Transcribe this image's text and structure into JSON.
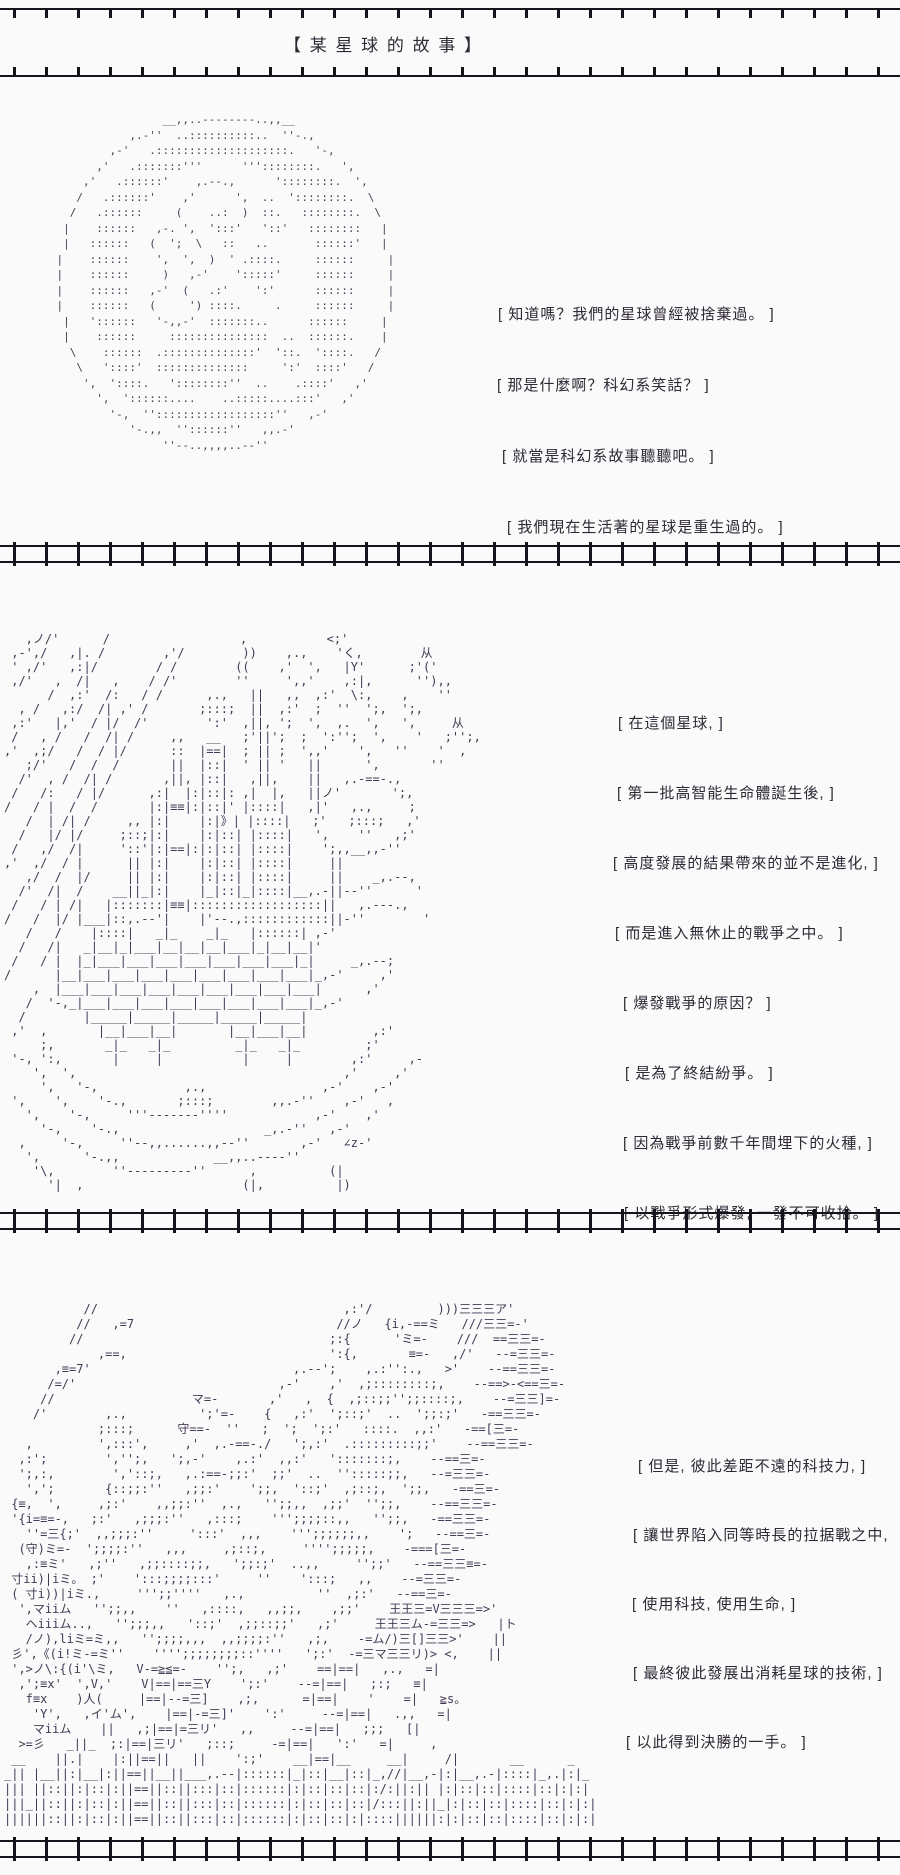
{
  "page": {
    "title": "【 某 星 球 的 故 事 】",
    "background_color": "#fafafa",
    "line_color": "#14141d",
    "text_color": "#2e2935",
    "art_color": "#453a55"
  },
  "panels": [
    {
      "label": "panel-1-abandoned-planet",
      "dialogue": [
        "[ 知道嗎？我們的星球曾經被捨棄過。 ]",
        "[ 那是什麼啊？科幻系笑話？ ]",
        "[ 就當是科幻系故事聽聽吧。 ]",
        "[ 我們現在生活著的星球是重生過的。 ]"
      ],
      "art": [
        "                    __,,..--------..,,__",
        "               ,.-''  ..::::::::::..  ''-.,",
        "            ,-'   .::::::::::::::::::::.   '-,",
        "          ,'   .:::::::'''      '''::::::::.   ',",
        "        ,'   .::::::'    ,.--.,      '::::::::.  ',",
        "       /   .::::::'    ,'      ',  ..  '::::::::.  \\",
        "      /   .::::::     (    ..:  )  ::.   ::::::::.  \\",
        "     |    ::::::   ,-. ',  ':::'   '::'   ::::::::   |",
        "     |   ::::::   (  ';  \\   ::   ..       ::::::'   |",
        "    |    ::::::    ',  ',  )  ' .::::.     ::::::     |",
        "    |    ::::::     )   ,-'    ':::::'     ::::::     |",
        "    |    ::::::   ,-'  (   .:'    ':'      ::::::     |",
        "    |    ::::::   (     ') ::::.     .     ::::::     |",
        "     |   '::::::   '-,,-'  :::::::..      ::::::     |",
        "     |    ::::::     :::::::::::::::  ..  ::::::.    |",
        "      \\    ::::::  .::::::::::::::'  '::.  '::::.   /",
        "       \\   '::::'  ::::::::::::::     ':'  ::::'   /",
        "        ',  '::::.   '::::::::''  ..    .::::'   ,'",
        "          ',  '::::::....    ..:::::....:::'   ,'",
        "            '-,  ''::::::::::::::::::''   ,-'",
        "               '-.,,  ''::::::''   ,,.-'",
        "                    ''--..,,,,..--''"
      ]
    },
    {
      "label": "panel-2-war-city",
      "dialogue": [
        "[ 在這個星球, ]",
        "[ 第一批高智能生命體誕生後, ]",
        "[ 高度發展的結果帶來的並不是進化, ]",
        "[ 而是進入無休止的戰爭之中。 ]",
        "[ 爆發戰爭的原因？ ]",
        "[ 是為了終結紛爭。 ]",
        "[ 因為戰爭前數千年間埋下的火種, ]",
        "[ 以戰爭形式爆發, 一發不可收拾。 ]"
      ],
      "art": [
        "   ,ノ/'      /                  ,           <;'",
        " ,-',/   ,|. /        ,'/        ))    ,.,    'く,        从",
        " ' ,/'   ,:|/        / /        ((    ,'  ',   |Y'      ;'('",
        " ,/'   ,  /|   ,    / /'        ''     ',,'    ,:|,      ''),,",
        "      /  ,:'  /:   / /      ,.,   ||   ,,  ,:'  \\:,    ,    ''",
        "  , /   ,:/  /| ,' /       ;:::;  ||  ,:'  ;  ''  ';,  ';,",
        " ,:'   |,'  / |/  /'        ':'  ,||, ';  ',  ,.  ',   ',     从",
        " /   , /   /  /| /     ,,   __   ;'||';  ;  ':'';  ',    '   ;'';,",
        ",'  ,;/   /  / |/      ::  |==|  ; || ;  ',,'    ',   ''    '  ,",
        "   ;/'   /  /  /       ||  |::|  ' || '   ||      ',       ''",
        "  /'  , /  /| /       ,||, |::|   ,||,    ||   ,.-==-.,",
        " /   /:   / |/      ,:|  |:|::|: ,|  |,   ||ノ'       ';,",
        "/   / |  /  /       |:|≡≡|:|::|' |::::|   ,|'   ,.,     ;",
        "   /  | /| /     ,, |:|    |:|》| |::::|   ;'   ;:::;   ,'",
        "  /   |/ |/     ;::;|:|    |:|::| |::::|   ',    ''   ,;'",
        " /   ,/  /|     '::'|:|==|:|:|::| |::::|    ';,,__,,-''",
        ",'  ,/  / |      || |:|    |:|::| |::::|     ||",
        "   ,/  /  |/     || |:|    |:|::| |::::|     ||    _,.--,",
        "  /'  /|  /    __||_|:|    |_|::|_|::::|__,.-||--''      '",
        " /   / | /|   |:::::::|≡≡|::::::::::::::::::||   ,.---.,",
        "/   /  |/ |___|::,.--'|    |'--.,::::::::::::||-''        '",
        "   /   /    |::::|   _|_    _|_   |::::::| ,-'",
        "  /   /|   _|__|_|___|__|__|__|___|_|__|__|'",
        " /   / |  |_|___|___|___|___|___|___|___|_|     _,.--;",
        "/      |__|___|___|___|___|___|___|___|___|_,-'     ,'",
        "    ,  |___|___|___|___|___|___|___|___|___|      ,'",
        "   /  '-,_|___|___|___|___|___|___|___|___|_,-'",
        "  /        |_____|_____|_____|_____|_____|",
        " ,'  ,       |__|___|__|       |__|___|__|         ,:'",
        "     ;,       _|_   _|_         _|_   _|_         ;'",
        " '-, ':,       |     |           |     |        ,:'     ,-",
        "    ',  ',                                     ,'     ,'",
        "     ',   '-,            ,.,                ,-'    ,-'",
        " ',    ',    '-.,       ;:::;        ,,.-''    ,-'   ,",
        "   ',    '-,     '''-------''''            ,-'    ,'",
        "     '-,    '-.,                    _,.-''   ,-'",
        "  ,     '-,     ''--,,......,,--''       ,-'   ∠z-'",
        "   ',      '-.,,             __,,..----''",
        "    '\\,        ''---------''      ,          (|",
        "      '|  ,                      (|,          |)"
      ]
    },
    {
      "label": "panel-3-final-weapon",
      "dialogue": [
        "[ 但是, 彼此差距不遠的科技力, ]",
        "[ 讓世界陷入同等時長的拉据戰之中,",
        "[ 使用科技, 使用生命, ]",
        "[ 最終彼此發展出消耗星球的技術, ]",
        "[ 以此得到決勝的一手。 ]"
      ],
      "art": [
        "           //                                  ,:'/         )))三三三ア'",
        "          //   ,=7                            //ノ   {i,-==ミ   ///三三=-'",
        "         //                                  ;:{      'ミ=-    ///  ==三三=-",
        "             ,==,                            ':{,       ≡=-   ,/'   --=三三=-",
        "       ,≡=7'                            ,.--';    ,.:'':.,   >'    --==三三=-",
        "      /=/'                            ,-'    ,'  ,;::::::::;,    --==>-<==三=-",
        "     //                   マ=-       ,'   ,  {  ,;::;;'';;::::;,    --=三三]=-",
        "    /'        ,.,          ';'=-    {   ,:'  ';::;'  ..  ';;:;'   -==三三=-",
        "             ;:::;      守==-  ''   ;  ';  ';:'   ::::.  ,,:'   -==[三=-",
        "   ,         ',:::',     ,'  ,.-==-./   ';,:'  .:::::::::;;'    --==三三=-",
        "  ,:';        ','';,   ';,-'    ,.:'  ,,:'   ':::::::;,    --==三=-",
        "  ';,:,        ','::;,   ,.:==-;;:'  ;;'  ..  '':::::;;,   --=三三=-",
        "   ',';       {::;;:''   ,;;:'    ';;,  '::;'  ,;::;,  ';;,   -==三=-",
        " {≡,  ',     ,;:'    ,,;;:''  ,.,   '';;,,  ,;;'  '';;,    --==三三=-",
        " '{i=≡=-,   ;:'   ,;;;:''   ,:::;    ''';;;;::,,   '';;,   -==三三=-",
        "   ''=三{;'  ,,;;;:''     ':::'  ,,,    ''';;;;;;,,    ';   --==三=-",
        "  (守)ミ=-  ';;;;:''   ,,,     ,;::;,     '''';;;;;,    -===[三=-",
        "   ,:≡ミ'   ,;''   ,;;::::;;,   ';;:;'  ..,,     '';;'   --==三三≡=-",
        " 寸ii)|iミ。 ;'    ':::;;;;:::'     ''    ':::;   ,,    --=三三=-",
        " ( 寸i))|iミ.,     ''';;''''   ,.,          ''  ,;:'   --==三=-",
        "  ',マiiム   '';;,,    ''   ,::::,   ,,;;,    ,;;'    王王三=V三三三=>'",
        "   ヘiiiム..,   '';;;,,   '::;'  ,;;::;;'   ,;'     王王三ム-=三三=>   |ト",
        "   /ノ),liミ=ミ,,   '';;;;,,,  ,,;;;;:''   ,;,    -=ム/)三[]三三>'    ||",
        " 彡',《(i!ミ-=ミ''    '''';;;;;;;;::''''   ';:'  -=三マ三三リ)> <,    ||",
        " ',>ノ\\:{(i'\\ミ,   V-=≧≦=-    '';,   ,;'    ==|==|   ,.,   =|",
        "  ,';≡x'  ',V,'    V|==|==三Y    ';:'    --=|==|   ;:;   ≡|",
        "   f≡x    )人(     |==|--=三]    ,;,      =|==|    '    =|   ≧s。",
        "    'Y',   ,イ'ム',    |==|-=三]'    ':'     --=|==|   .,,   =|",
        "    マiiム    ||   ,;|==|=三リ'   ,,     --=|==|   ;;;   [|",
        "  >=彡   _||_  ;:|==|三リ'   ;::;     -=|==|   ':'   =|     ,",
        " __    ||.|    |:||==||   ||    ':;'    __|==|__     __|     /|       __      _",
        "_|| |__||:|__|:||==||__||___,.--|::::::|_|::|__|::|_,//|__,-|:|__,.-|::::|_,.|:|_",
        "||| ||::||:|::|:||==||::||:::|::|::::::|:|::|::|::|:/:||:|| |:|::|::|::::|::|:|:|",
        "|||_||::||:|::|:||==||::||:::|::|::::::|:|::|::|::|/:::||:||_|:|::|::|::::|::|:|:|",
        "||||||::||:|::|:||==||::||:::|::|::::::|:|::|::|:|::::||||||:|:|::|::|::::|::|:|:|"
      ]
    }
  ]
}
